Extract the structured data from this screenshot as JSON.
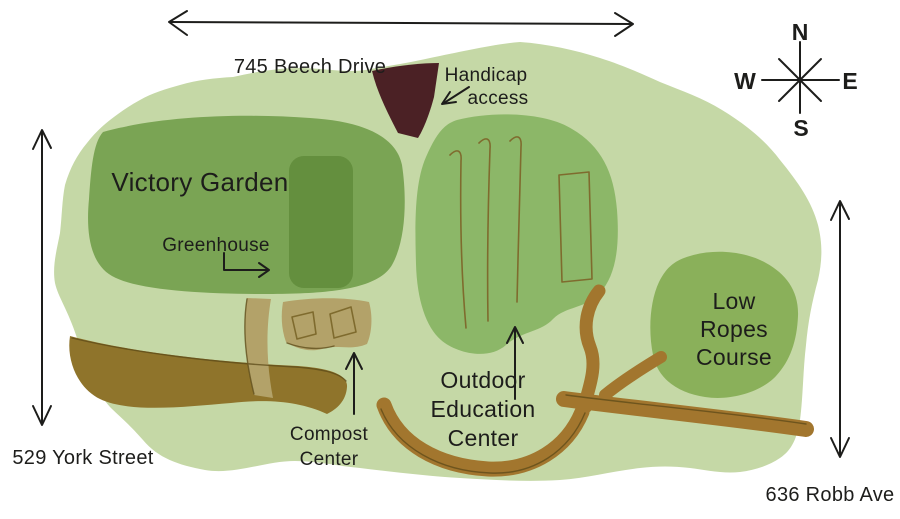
{
  "map": {
    "streets": {
      "top": "745 Beech Drive",
      "left": "529 York Street",
      "right": "636 Robb Ave"
    },
    "labels": {
      "victory_garden": "Victory Garden",
      "greenhouse": "Greenhouse",
      "handicap_1": "Handicap",
      "handicap_2": "access",
      "outdoor_1": "Outdoor",
      "outdoor_2": "Education",
      "outdoor_3": "Center",
      "compost_1": "Compost",
      "compost_2": "Center",
      "ropes_1": "Low",
      "ropes_2": "Ropes",
      "ropes_3": "Course"
    },
    "compass": {
      "north": "N",
      "east": "E",
      "south": "S",
      "west": "W"
    },
    "colors": {
      "background": "#ffffff",
      "site": "#c5d8a6",
      "victory_garden": "#7aa454",
      "greenhouse": "#648f3e",
      "outdoor_ed": "#8cb768",
      "low_ropes": "#8ab05a",
      "path_dark": "#8f742b",
      "path_light": "#a2762e",
      "compost_tan": "#b3a269",
      "bed_line": "#7f6b2e",
      "sketch_line": "#5c4a18",
      "driveway": "#4b2125",
      "ink": "#1d1d1b"
    }
  }
}
